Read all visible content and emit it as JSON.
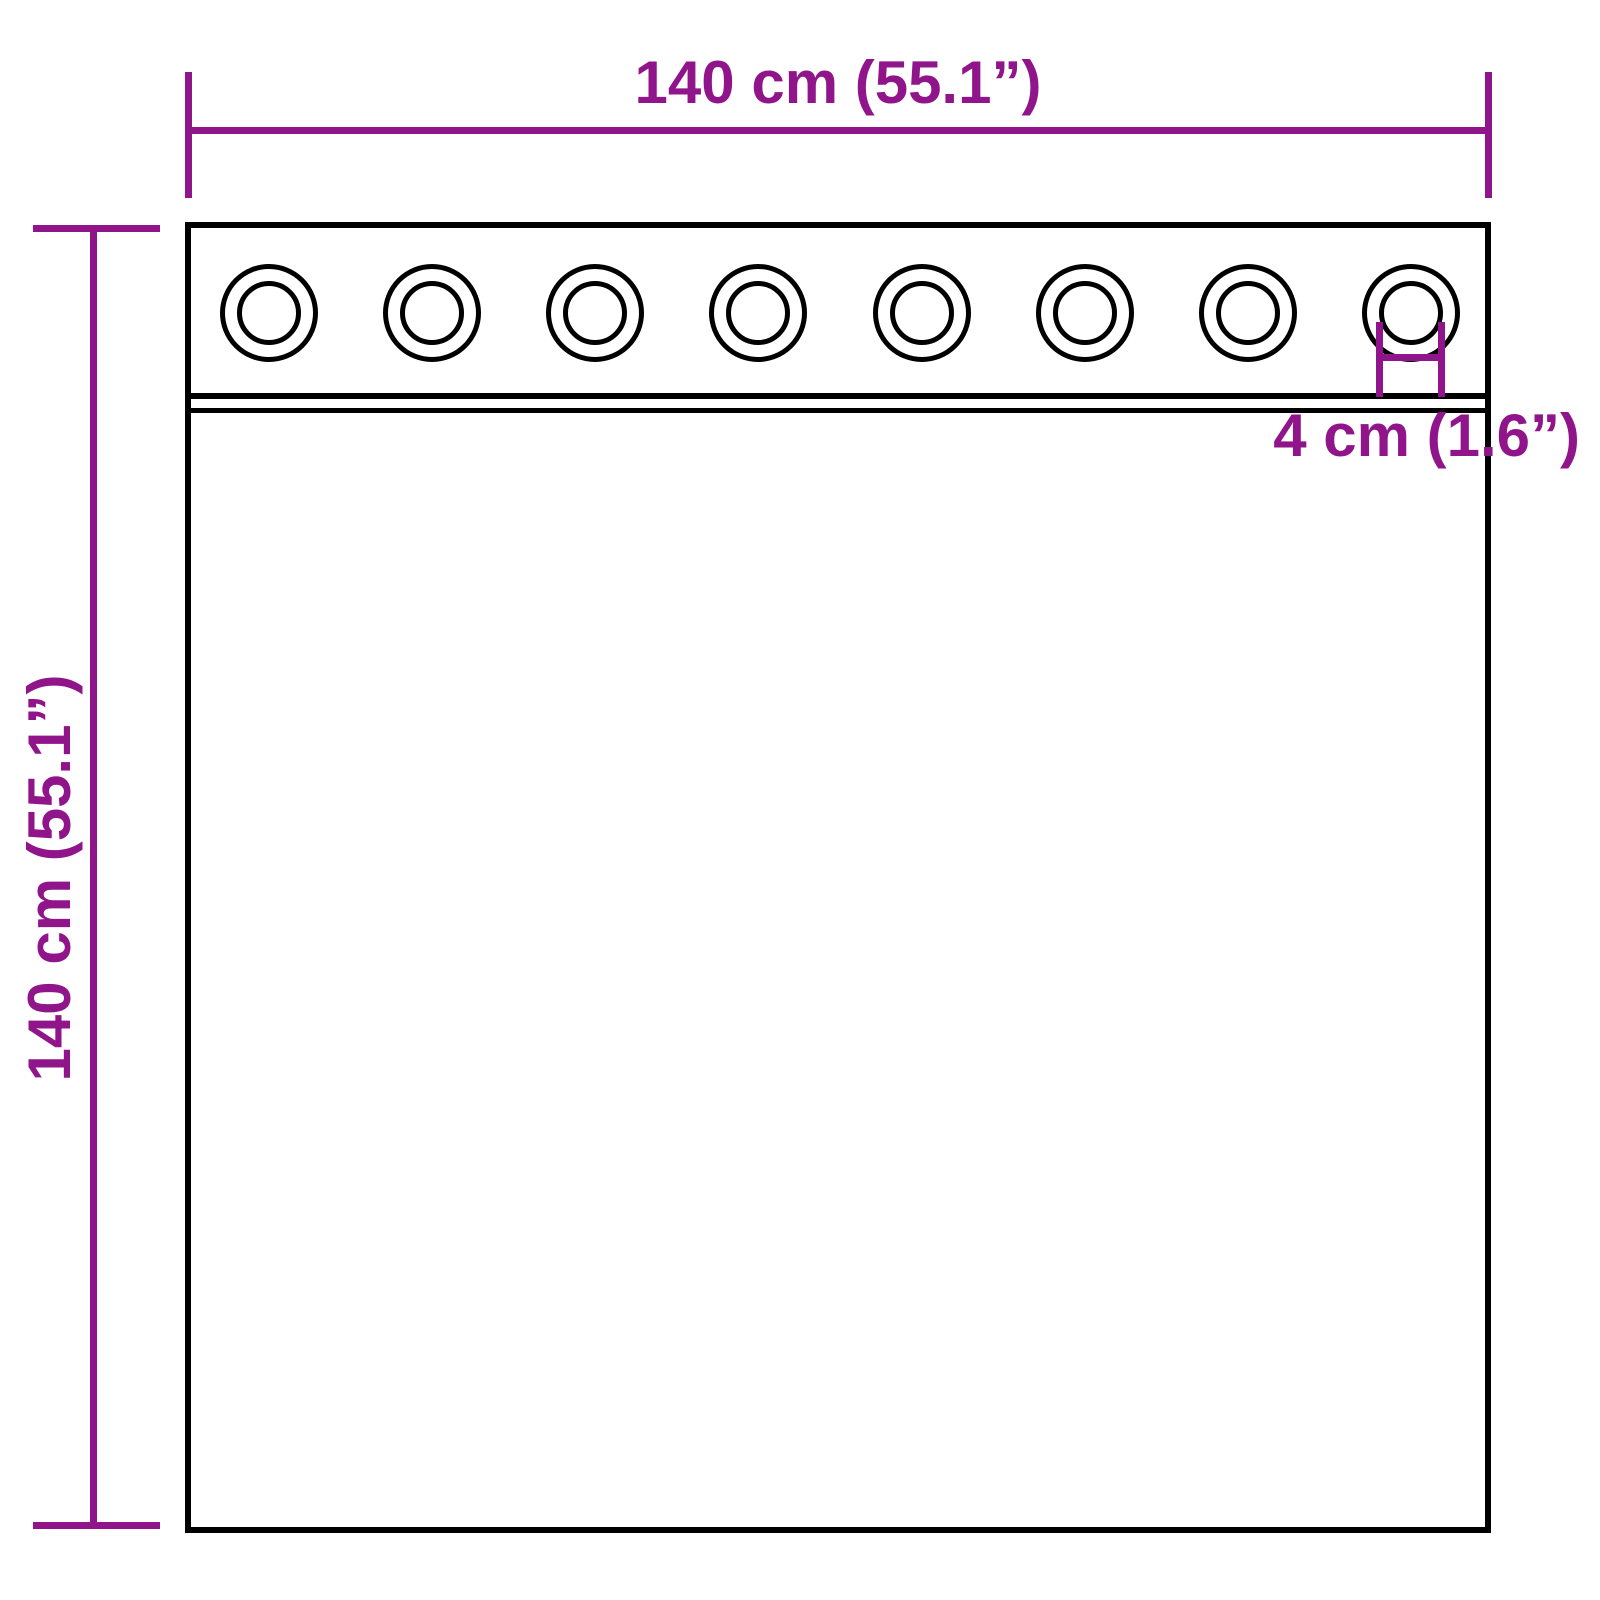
{
  "diagram": {
    "type": "curtain-with-grommets-dimension-diagram",
    "width_dimension": {
      "label": "140 cm (55.1”)"
    },
    "height_dimension": {
      "label": "140 cm (55.1”)"
    },
    "grommet_dimension": {
      "label": "4 cm (1.6”)"
    },
    "grommet_count": 8,
    "colors": {
      "dimension_color": "#90148a",
      "outline_color": "#000000",
      "background": "#ffffff"
    }
  }
}
